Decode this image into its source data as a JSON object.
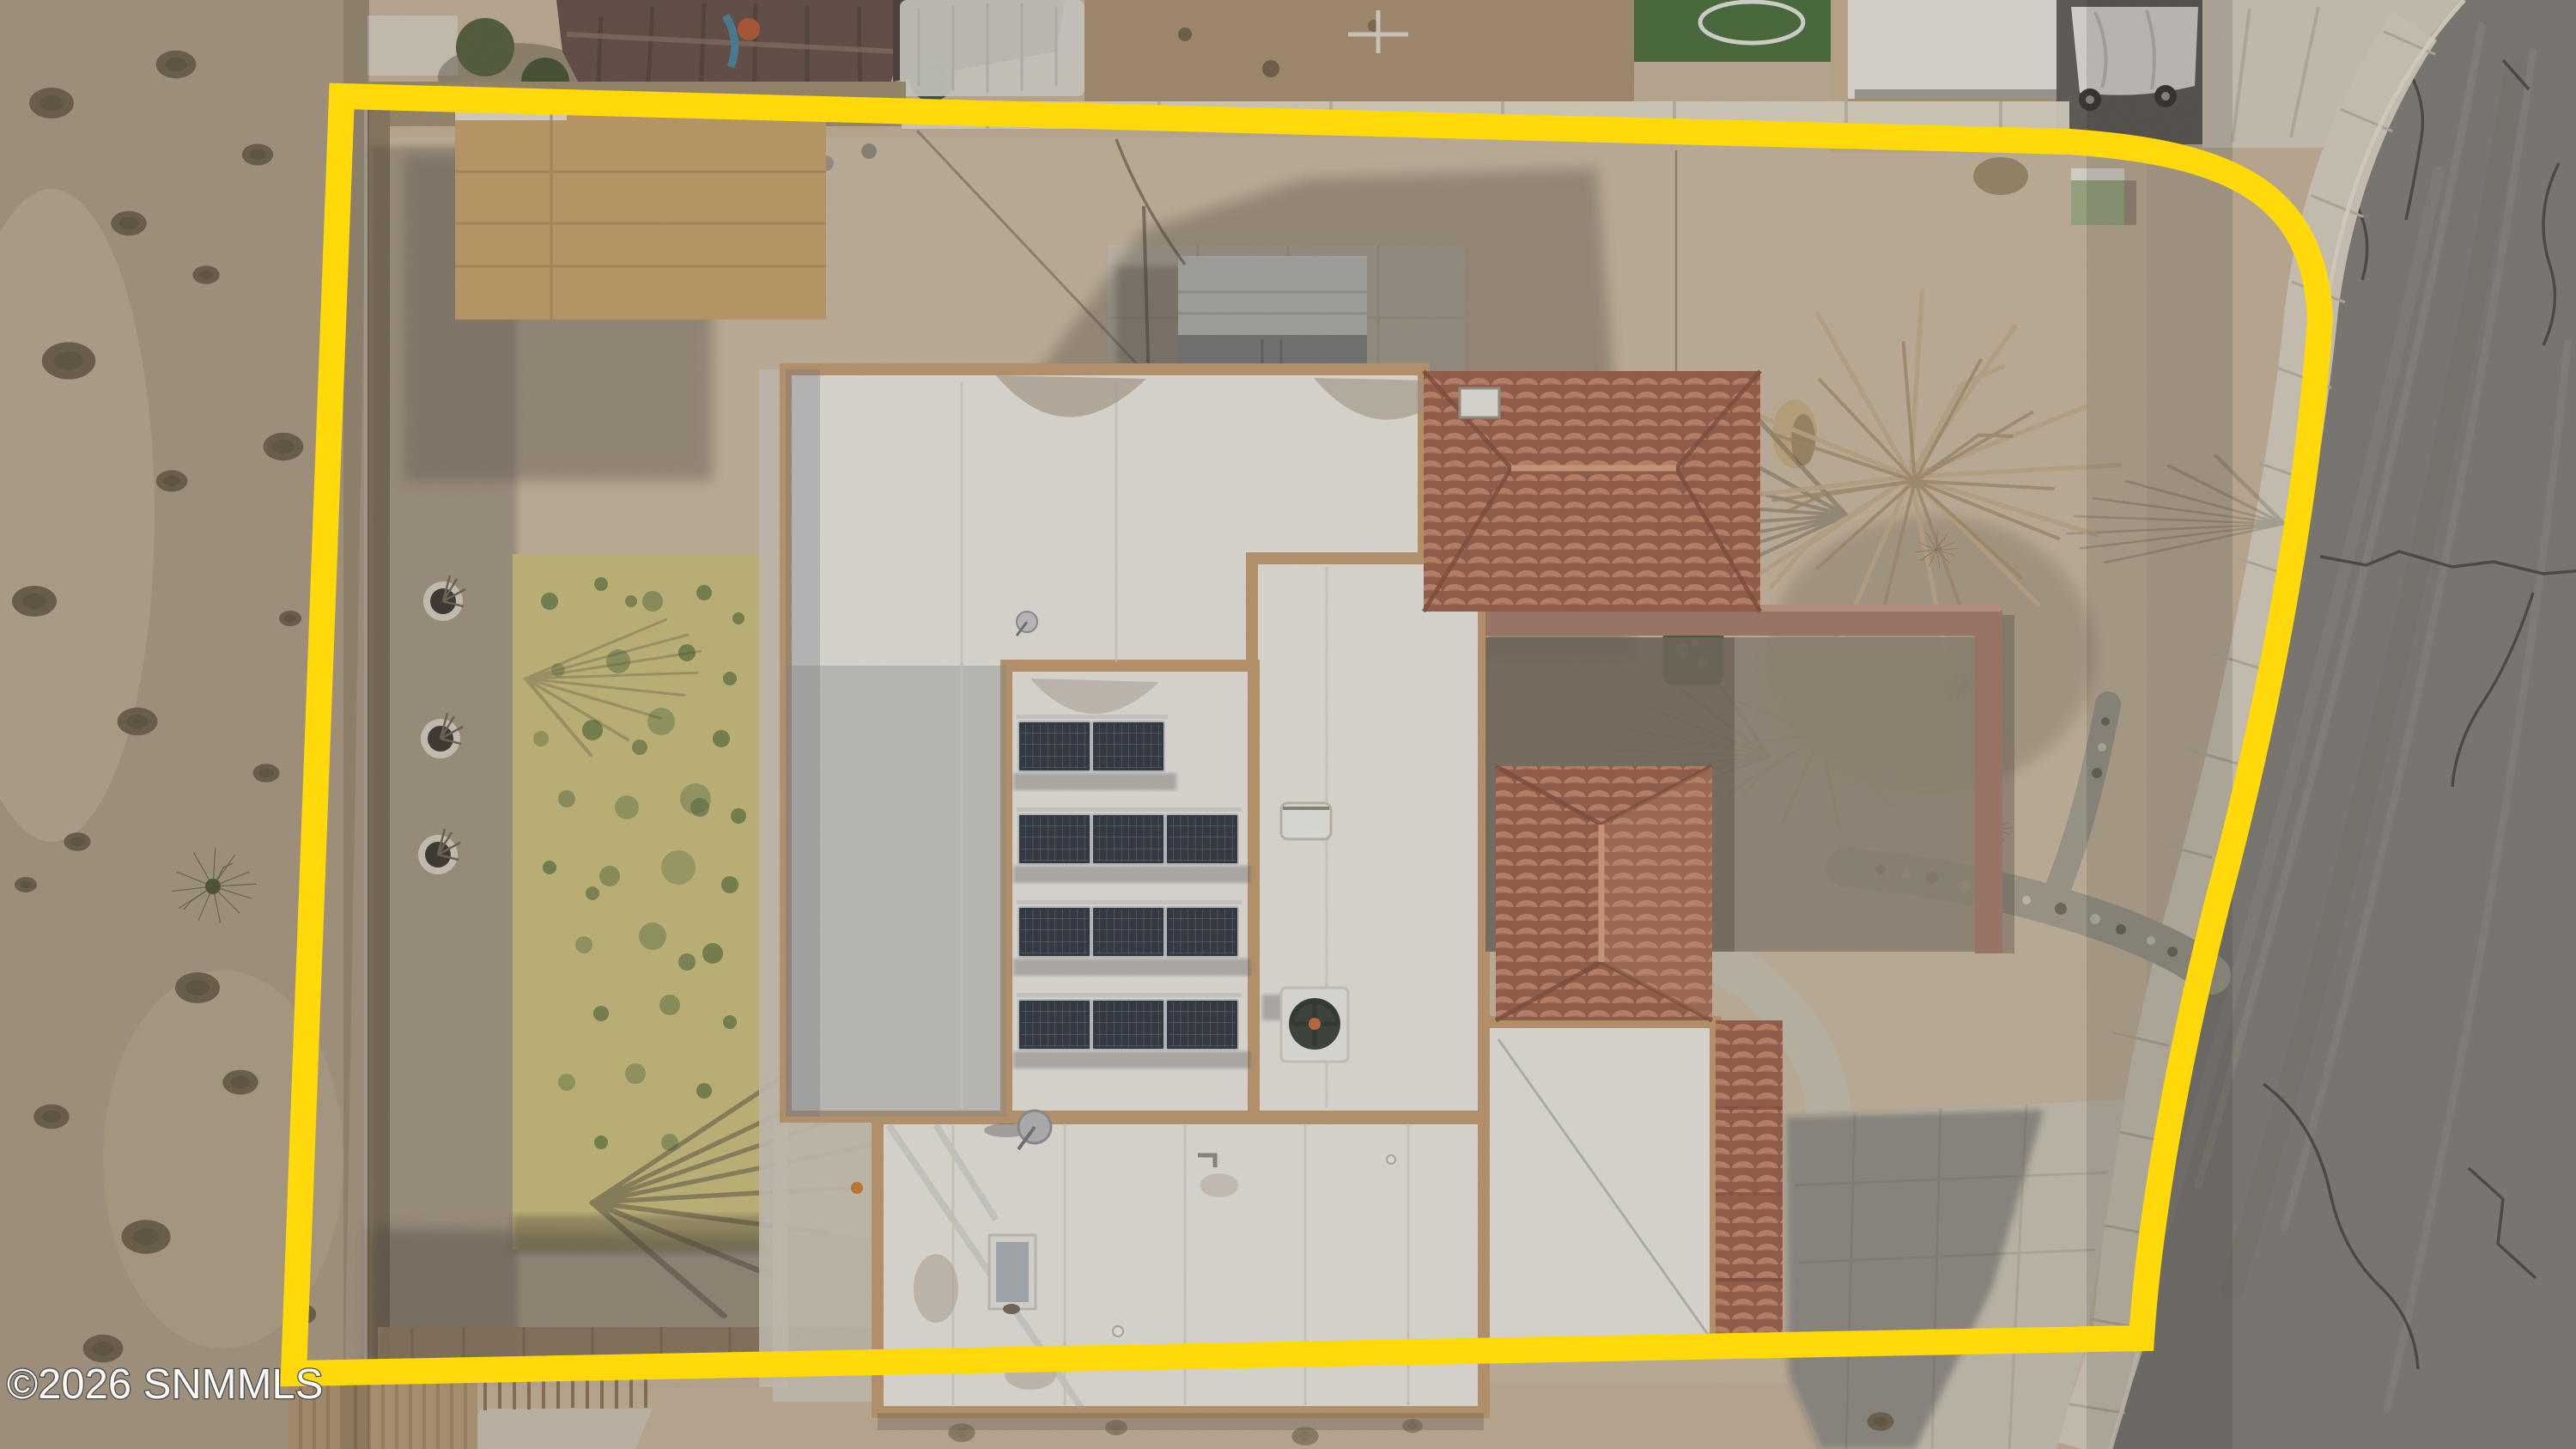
{
  "watermark": {
    "text": "©2026 SNMMLS",
    "color": "#ffffff",
    "outline_color": "#454545"
  },
  "boundary": {
    "color": "#ffd90a",
    "style": "thick solid property outline"
  },
  "colors": {
    "gravel": "#c7b49c",
    "gravel_light": "#d0bfa7",
    "desert": "#b2a189",
    "asphalt": "#7b7977",
    "sidewalk": "#d8d2c4",
    "concrete": "#cdc7b9",
    "roof_white": "#f1f0eb",
    "roof_parapet": "#c49c71",
    "roof_tile": "#b5735a",
    "lawn": "#cec27e",
    "lawn_green": "#75854c",
    "solar_panel": "#232d3a",
    "shadow": "#3f3a35",
    "shed_tan": "#c8a169",
    "shed_gray": "#8e9299",
    "hedge_green": "#3e5a32",
    "courtyard_wall": "#a4786b"
  },
  "solar_array": {
    "rows": [
      2,
      3,
      3,
      3
    ],
    "total_panels": 11
  },
  "features": [
    "property-boundary-outline",
    "flat-white-roof-house",
    "rooftop-solar-array",
    "terracotta-tile-roof-sections",
    "swamp-cooler-unit",
    "satellite-dish",
    "skylight",
    "dormant-lawn-patch",
    "tree-wells",
    "storage-shed",
    "tan-shade-roof",
    "stone-retaining-wall",
    "desert-strip",
    "street-with-cracks",
    "curved-sidewalk",
    "concrete-driveway",
    "rock-drainage-bed",
    "bare-trees",
    "trimmed-hedges",
    "utility-box",
    "neighbor-gazebo",
    "neighbor-covered-vehicle",
    "neighbor-lawn-trampoline"
  ]
}
